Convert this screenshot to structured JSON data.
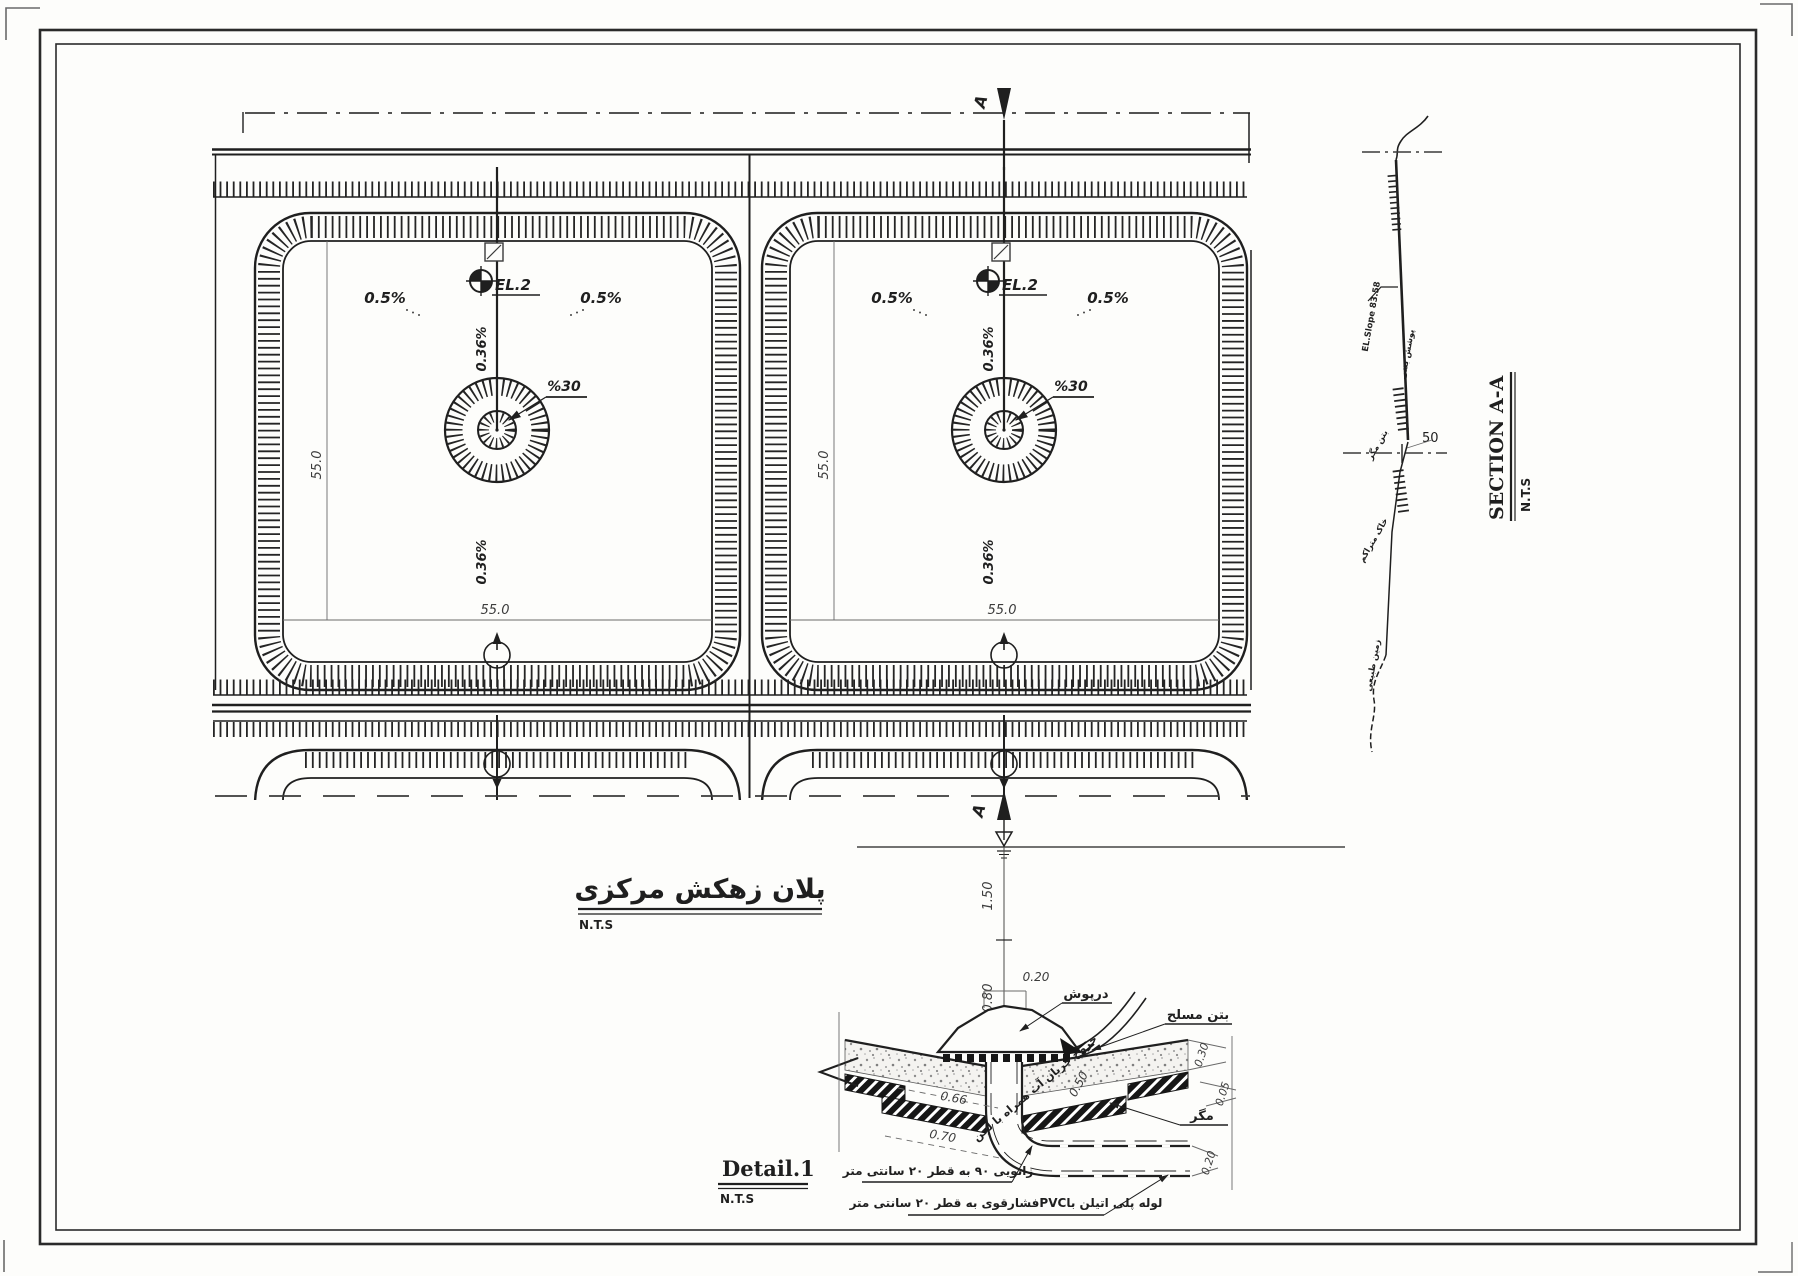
{
  "plan": {
    "title": "پلان زهکش مرکزی",
    "nts": "N.T.S",
    "slope": "0.5%",
    "grade": "0.36%",
    "drain_grade": "%30",
    "benchmark": "EL.2",
    "side_dim": "55.0",
    "section_letter": "A"
  },
  "section": {
    "title": "SECTION A-A",
    "nts": "N.T.S",
    "offset_dim": "50",
    "labels": [
      "EL.Slope 83.58",
      "پوشش بتنی",
      "بتن مگر",
      "خاک متراکم",
      "زمین طبیعی"
    ]
  },
  "detail": {
    "title": "Detail.1",
    "nts": "N.T.S",
    "dim_150": "1.50",
    "dim_080": "0.80",
    "dim_020": "0.20",
    "dim_066": "0.66",
    "dim_050": "0.50",
    "dim_070": "0.70",
    "dim_030": "0.30",
    "dim_005": "0.05",
    "dim_pipe": "0.20",
    "label_cap": "درپوش",
    "label_outflow": "خروج جریان آب همراه با لجن",
    "label_rc": "بتن مسلح",
    "label_lean": "مگر",
    "label_elbow": "زانویی ۹۰ به قطر ۲۰ سانتی متر",
    "label_pipe": "لوله پلی اتیلن باPVCفشارقوی به قطر ۲۰ سانتی متر"
  },
  "colors": {
    "ink": "#1f1f1f",
    "dim_line": "#6a6a6a",
    "paper": "#fdfdfb"
  }
}
